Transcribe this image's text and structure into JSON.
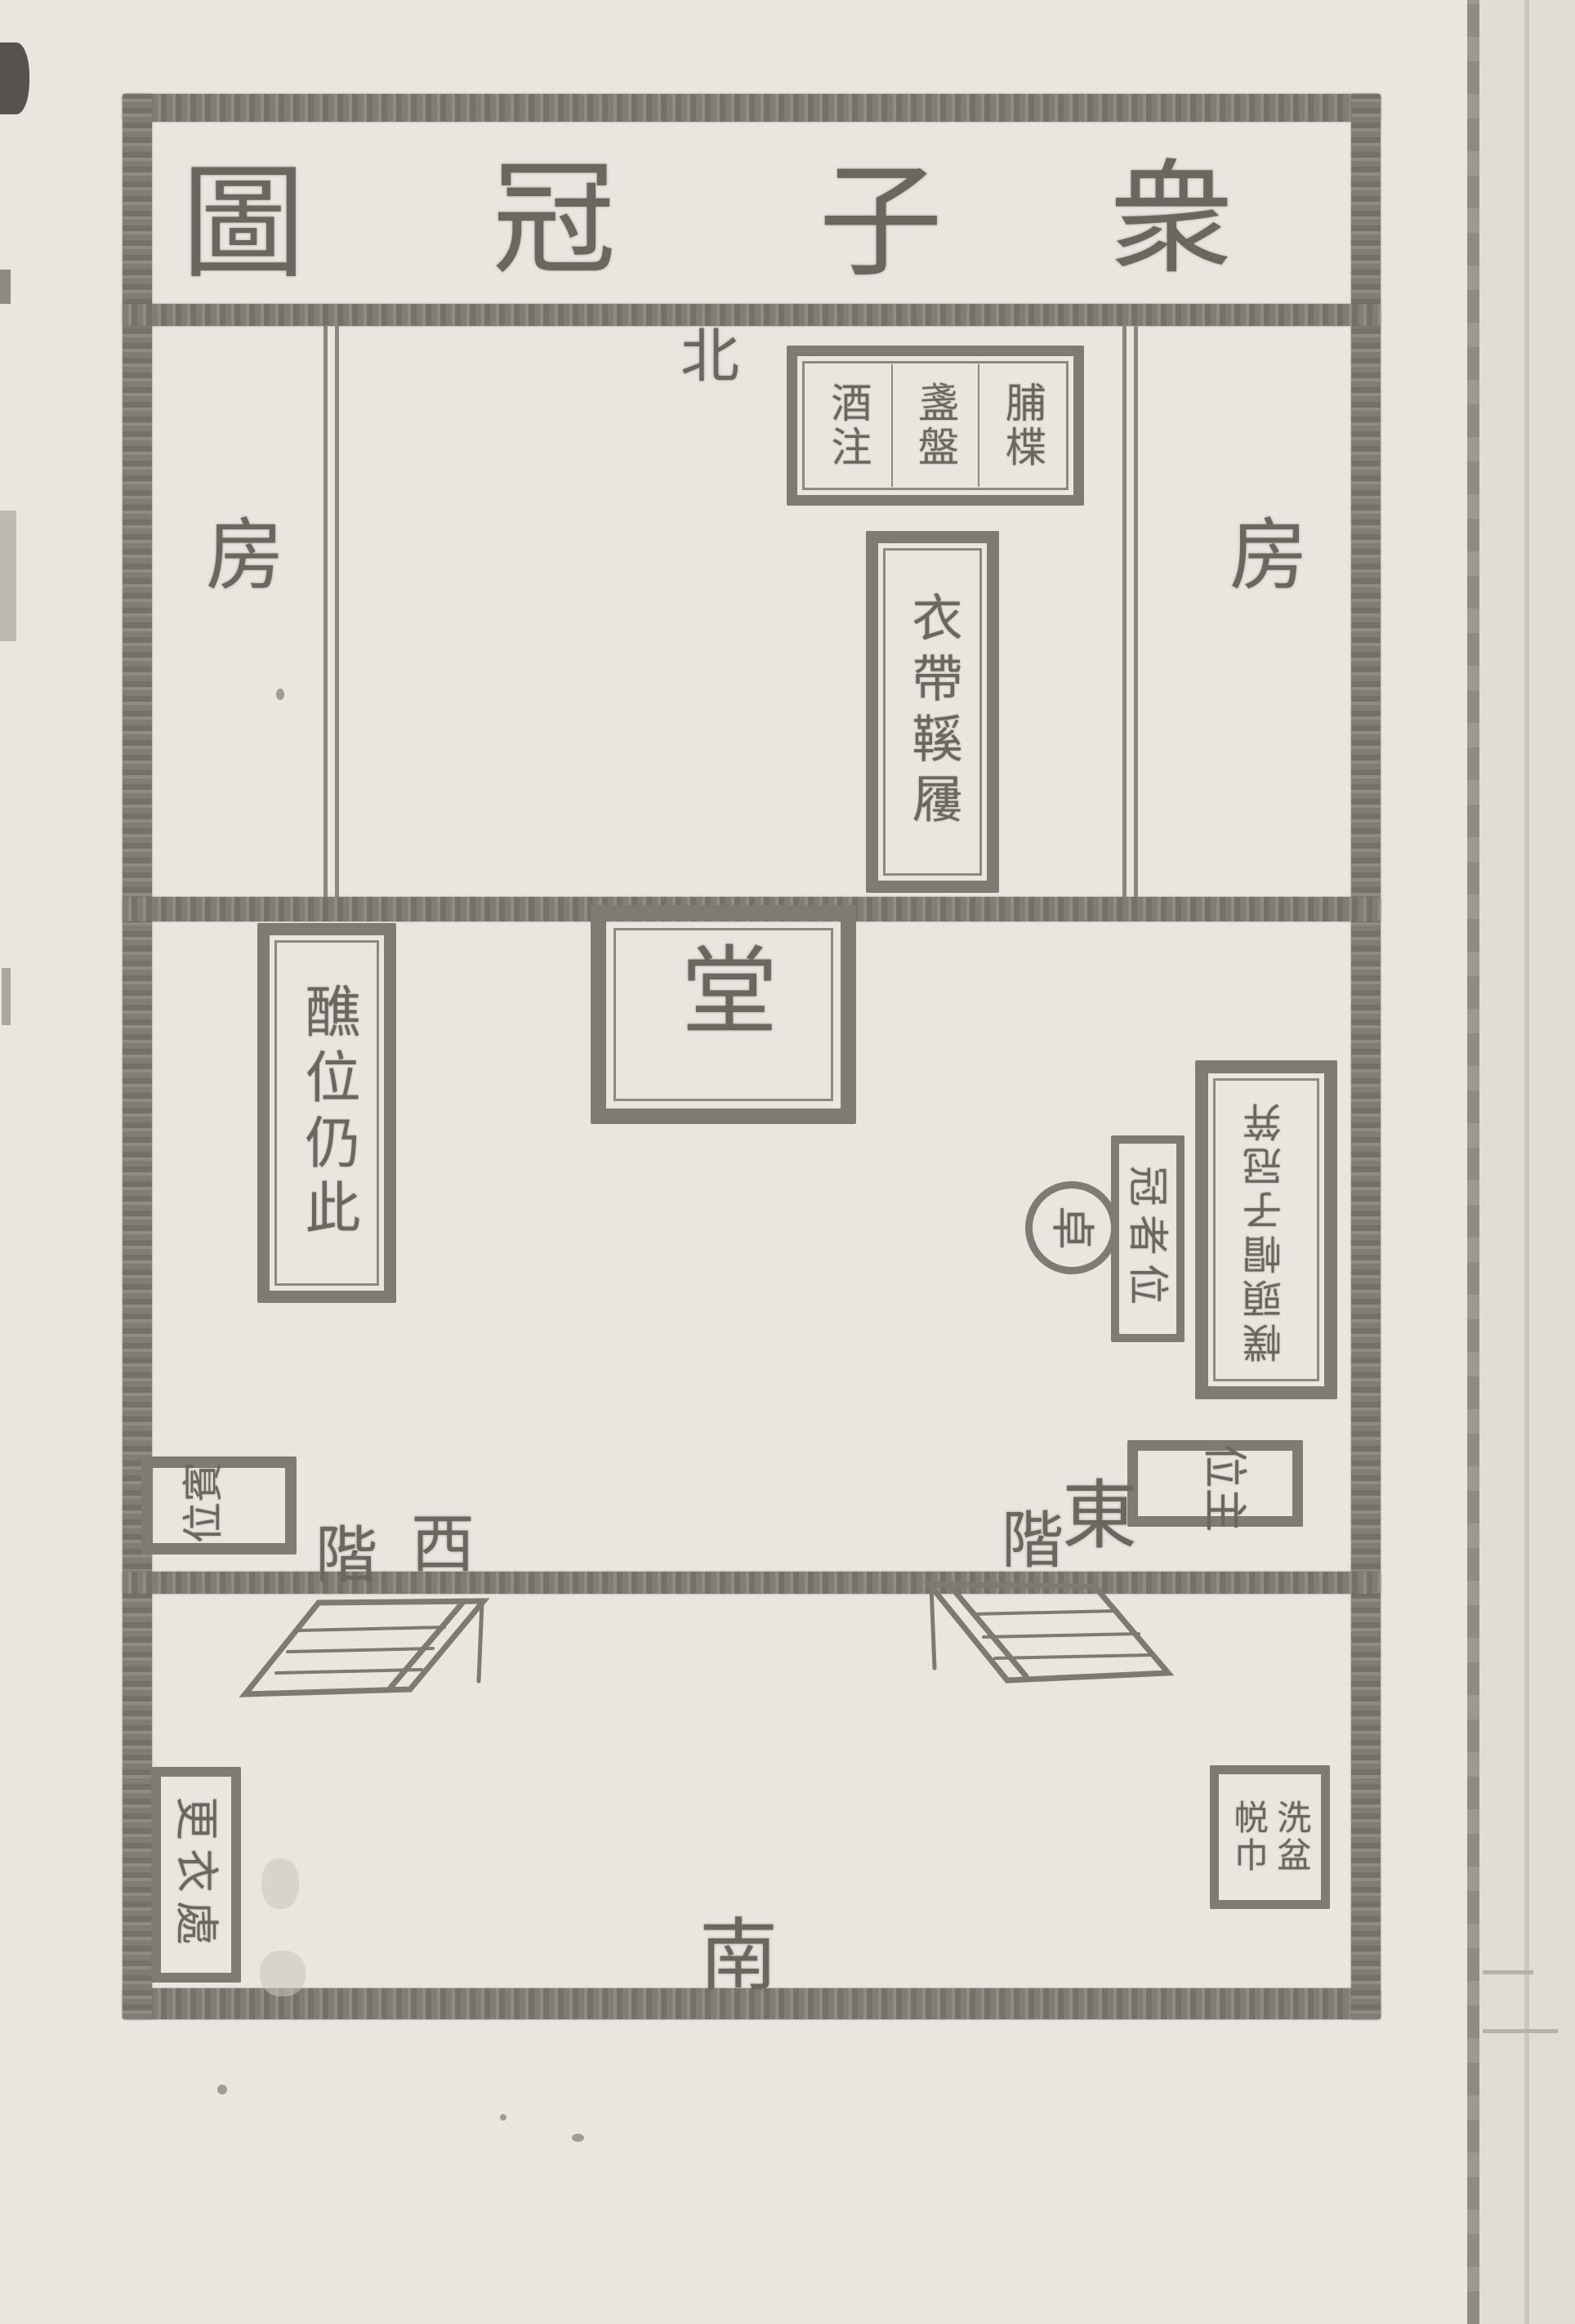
{
  "diagram": {
    "title": {
      "reading_rtl": "衆子冠圖",
      "chars": [
        "圖",
        "冠",
        "子",
        "衆"
      ]
    },
    "compass": {
      "north": "北",
      "south": "南"
    },
    "rooms": {
      "left": "房",
      "right": "房"
    },
    "hall": "堂",
    "offering_table": {
      "col_right": "脯楪",
      "col_mid": "盞盤",
      "col_left": "酒注"
    },
    "garment_table": "衣帶鞵屨",
    "jiao_position": "醮位仍此",
    "caps_table_rotated": "幞頭帽子冠笄",
    "round_table": "卓",
    "capped_son_position": "冠者位",
    "host_position": "主位",
    "guest_position": "賓位",
    "changing_place": "更衣處",
    "washing": {
      "col_right": "洗盆",
      "col_left": "帨巾"
    },
    "east_stair_label": {
      "left_char": "階",
      "right_char": "東"
    },
    "west_stair_label": {
      "left_char": "階",
      "right_char": "西"
    },
    "colors": {
      "paper": "#e9e6e0",
      "ink": "#6b675f",
      "wall": "#7f7b73"
    }
  }
}
